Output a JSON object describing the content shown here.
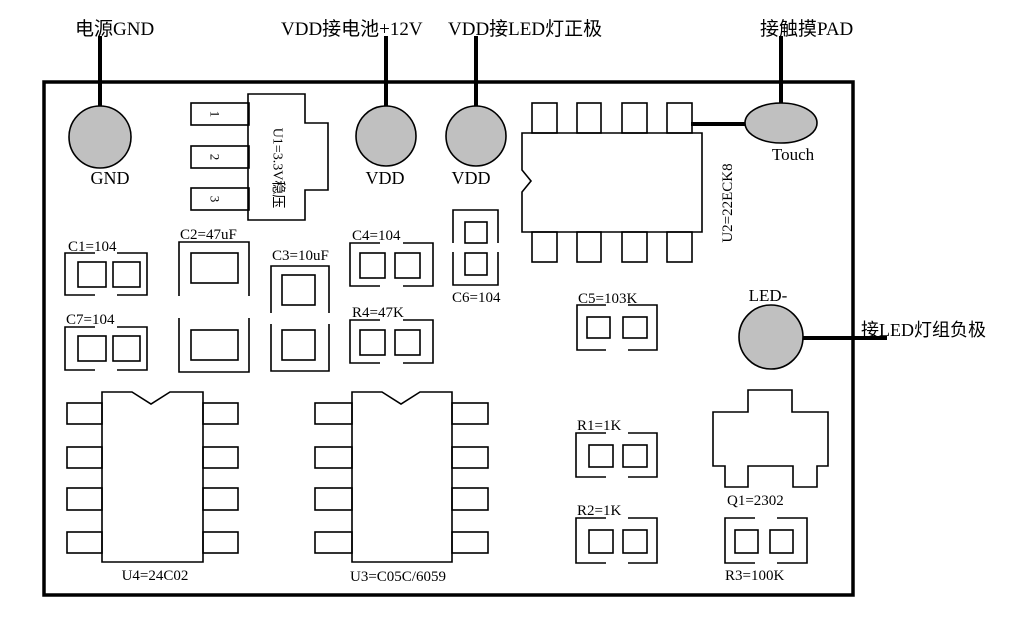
{
  "annotations": {
    "power_gnd": "电源GND",
    "vdd_battery": "VDD接电池+12V",
    "vdd_led_positive": "VDD接LED灯正极",
    "touch_pad": "接触摸PAD",
    "led_group_negative": "接LED灯组负极"
  },
  "pads": {
    "gnd": {
      "label": "GND"
    },
    "vdd_left": {
      "label": "VDD"
    },
    "vdd_right": {
      "label": "VDD"
    },
    "touch": {
      "label": "Touch"
    },
    "led_minus": {
      "label": "LED-"
    }
  },
  "components": {
    "u1": {
      "label": "U1=3.3V稳压",
      "pins": [
        "1",
        "2",
        "3"
      ]
    },
    "u2": {
      "label": "U2=22ECK8"
    },
    "u3": {
      "label": "U3=C05C/6059"
    },
    "u4": {
      "label": "U4=24C02"
    },
    "c1": {
      "label": "C1=104"
    },
    "c2": {
      "label": "C2=47uF"
    },
    "c3": {
      "label": "C3=10uF"
    },
    "c4": {
      "label": "C4=104"
    },
    "c5": {
      "label": "C5=103K"
    },
    "c6": {
      "label": "C6=104"
    },
    "c7": {
      "label": "C7=104"
    },
    "r1": {
      "label": "R1=1K"
    },
    "r2": {
      "label": "R2=1K"
    },
    "r3": {
      "label": "R3=100K"
    },
    "r4": {
      "label": "R4=47K"
    },
    "q1": {
      "label": "Q1=2302"
    }
  },
  "colors": {
    "pad_fill": "#c0c0c0",
    "stroke": "#000000",
    "background": "#ffffff"
  }
}
